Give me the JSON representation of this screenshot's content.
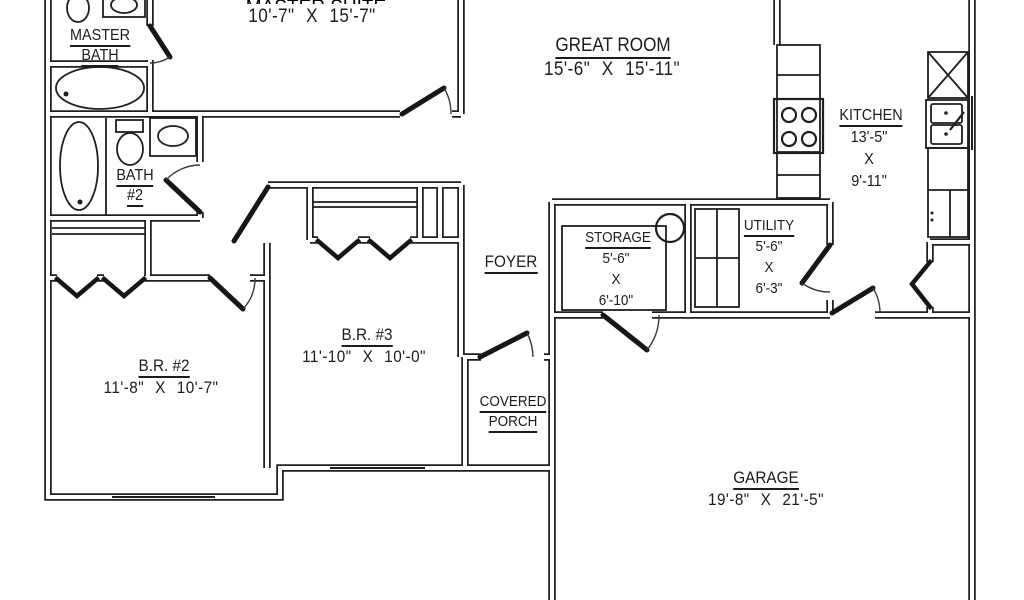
{
  "plan": {
    "title": "house floor plan",
    "colors": {
      "ink": "#1f1f1f",
      "paper": "#ffffff"
    },
    "rooms": {
      "master_suite": {
        "name": "MASTER SUITE",
        "dims": "10'-7\" X 15'-7\""
      },
      "master_bath": {
        "name_line1": "MASTER",
        "name_line2": "BATH"
      },
      "great_room": {
        "name": "GREAT ROOM",
        "dims": "15'-6\" X 15'-11\""
      },
      "kitchen": {
        "name": "KITCHEN",
        "dim_w": "13'-5\"",
        "dim_sep": "X",
        "dim_h": "9'-11\""
      },
      "bath_2": {
        "name_line1": "BATH",
        "name_line2": "#2"
      },
      "foyer": {
        "name": "FOYER"
      },
      "storage": {
        "name": "STORAGE",
        "dim_w": "5'-6\"",
        "dim_sep": "X",
        "dim_h": "6'-10\""
      },
      "utility": {
        "name": "UTILITY",
        "dim_w": "5'-6\"",
        "dim_sep": "X",
        "dim_h": "6'-3\""
      },
      "br_3": {
        "name": "B.R. #3",
        "dims": "11'-10\" X 10'-0\""
      },
      "br_2": {
        "name": "B.R. #2",
        "dims": "11'-8\" X 10'-7\""
      },
      "covered_porch": {
        "name_line1": "COVERED",
        "name_line2": "PORCH"
      },
      "garage": {
        "name": "GARAGE",
        "dims": "19'-8\" X 21'-5\""
      }
    }
  }
}
